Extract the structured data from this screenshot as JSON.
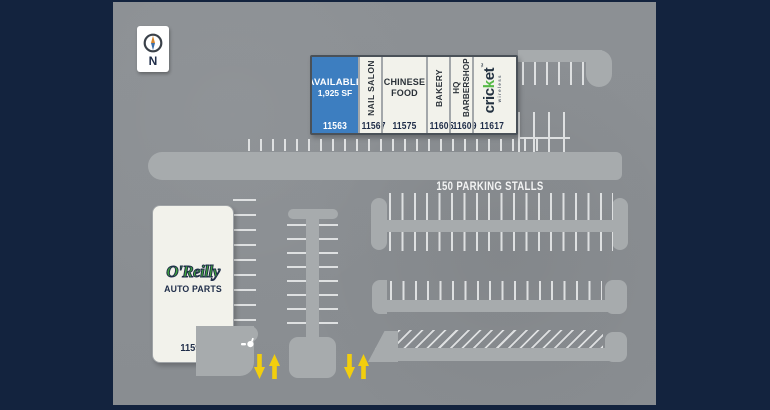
{
  "colors": {
    "navy": "#13233E",
    "plan_gray": "#8C9094",
    "road_gray": "#A7ABAD",
    "stall_line": "#DEE0E1",
    "building_fill": "#F2F2EB",
    "building_border": "#4A5158",
    "unit_divider": "#A3A7AA",
    "available_blue": "#3D7EC0",
    "text_navy": "#1F2D49",
    "label_dark": "#2A3138",
    "oreilly_green": "#3FA53C",
    "arrow_yellow": "#F2CE0D",
    "cricket_dark": "#233140",
    "cricket_green": "#56B947"
  },
  "compass": {
    "label": "N"
  },
  "strip": {
    "units": [
      {
        "type": "available",
        "line1": "AVAILABLE",
        "line2": "1,925 SF",
        "number": "11563"
      },
      {
        "type": "tenant",
        "tenant": "NAIL SALON",
        "number": "11567"
      },
      {
        "type": "tenant",
        "line1": "CHINESE",
        "line2": "FOOD",
        "number": "11575"
      },
      {
        "type": "tenant",
        "tenant": "BAKERY",
        "number": "11605"
      },
      {
        "type": "tenant",
        "line1": "HQ",
        "line2": "BARBERSHOP",
        "number": "11609"
      },
      {
        "type": "brand",
        "brand_pre": "cric",
        "brand_accent": "k",
        "brand_post": "et",
        "trademark": "™",
        "brand_sub": "wireless",
        "number": "11617"
      }
    ]
  },
  "parking_label": "150 PARKING STALLS",
  "oreilly": {
    "name": "O'Reilly",
    "tagline": "AUTO PARTS",
    "number": "11599"
  },
  "icons": {
    "compass": "compass-north-icon",
    "sign": "monument-sign-icon",
    "arrow_down": "entrance-arrow-down-icon",
    "arrow_up": "entrance-arrow-up-icon"
  }
}
